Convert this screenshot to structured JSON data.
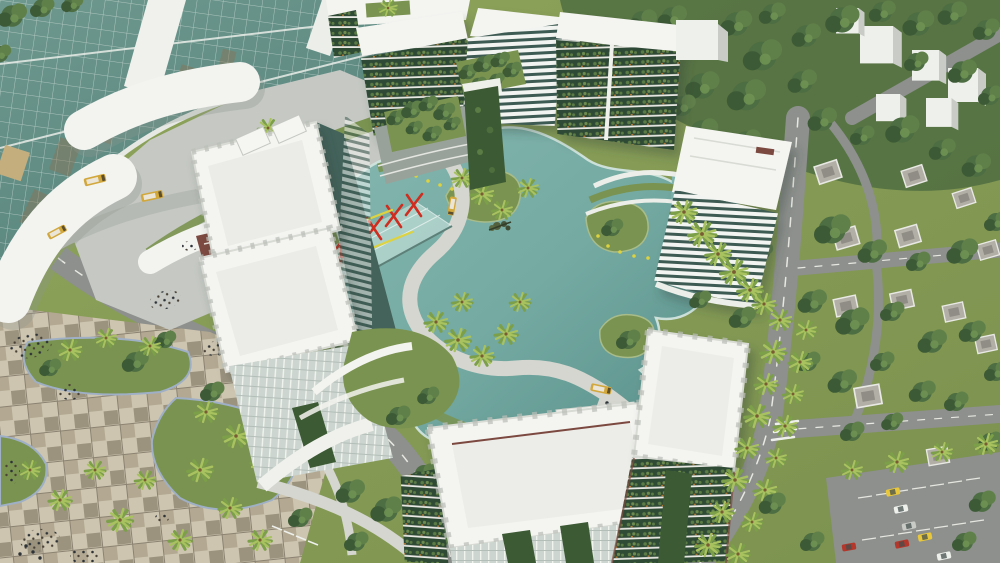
{
  "scene": {
    "title": "Aerial 3D architectural rendering of a mixed-use eco-city master plan",
    "description": "Bird's-eye render: curved glass transit tower and white canopies (top-left), vertical-garden apartment blocks around a winding teal lagoon with a pedestrian path, red art sculptures and banners, white slab towers with planted balconies in the foreground, checkered pedestrian plaza with palms and crowds (bottom-left), and a low-rise villa suburb with tree-lined roads and a parking lot (right).",
    "elements": {
      "glass_tower": "curved teal glass office tower",
      "transit_canopies": "white curved transit canopies with shuttle buses",
      "lagoon": "central landscaped lagoon",
      "lagoon_path": "winding pedestrian promenade",
      "art_canopy": "glass event canopy with red stick sculptures",
      "banners": "red event banners",
      "eco_towers": "green vertical-garden residential blocks",
      "louver_tower": "white horizontal-louver tower with roof garden",
      "west_tower": "white twin-slab tower with ladder parapets",
      "plaza": "checker-paved public plaza with crowds",
      "suburb": "villa neighborhood with tree-lined streets",
      "parking": "surface parking lot with cars",
      "vehicles": "yellow shuttle buses, taxi and cars"
    }
  },
  "colors": {
    "grass": "#879b55",
    "grass2": "#7a9350",
    "forest": "#4c6a40",
    "tree1": "#4d6d42",
    "tree2": "#3d5a36",
    "tree3": "#60804a",
    "palm": "#a8c25f",
    "palmDark": "#7c9f49",
    "water": "#74aba4",
    "waterDeep": "#55908b",
    "shore": "#cfe3dd",
    "path": "#d4d6cf",
    "road": "#8d908d",
    "apron": "#c5c8c3",
    "plazaA": "#cdc5b0",
    "plazaB": "#9c937f",
    "curb": "#9fb0c6",
    "white": "#f4f4f1",
    "whiteShade": "#e8e9e4",
    "whiteDark": "#bfc1bd",
    "glass": "#5f8d84",
    "glassDark": "#43635b",
    "brown": "#8a7354",
    "ecoDark": "#2f4a35",
    "ecoPlant": "#5c7c45",
    "vine": "#3c5a33",
    "orange": "#c97e33",
    "red": "#cf2d1f",
    "yellow": "#ddd23f",
    "bus": "#d2a83c",
    "houseRoof": "#b2afa6",
    "houseRoof2": "#8f8d85",
    "crowd": "#2e3338",
    "canopyGlass": "#b9d8d1",
    "maroon": "#7c4a40"
  }
}
